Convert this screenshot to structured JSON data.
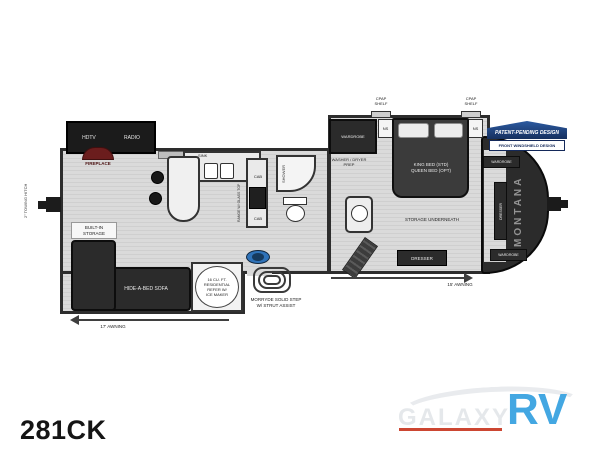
{
  "floorplan": {
    "model": "281CK",
    "brand_vertical": "MONTANA",
    "badge": {
      "title": "PATENT-PENDING DESIGN",
      "subtitle": "FRONT WINDSHIELD DESIGN"
    },
    "exterior": {
      "towing_hitch": "2\" TOWING HITCH",
      "awning_rear": "17' AWNING",
      "awning_front": "15' AWNING",
      "step_line1": "MORRYDE SOLID STEP",
      "step_line2": "W/ STRUT ASSIST"
    },
    "living": {
      "hdtv": "HDTV",
      "radio": "RADIO",
      "fireplace": "FIREPLACE",
      "built_in_storage_line1": "BUILT-IN",
      "built_in_storage_line2": "STORAGE",
      "sofa": "HIDE-A-BED SOFA"
    },
    "kitchen": {
      "sink": "SINK",
      "range": "RANGE W/ GLASS TOP",
      "cab_upper": "CAB",
      "cab_lower": "CAB",
      "refer_line1": "16 CU. FT.",
      "refer_line2": "RESIDENTIAL",
      "refer_line3": "REFER W/",
      "refer_line4": "ICE MAKER"
    },
    "bath": {
      "shower": "SHOWER",
      "washer_dryer_line1": "WASHER / DRYER",
      "washer_dryer_line2": "PREP"
    },
    "bedroom": {
      "wardrobe": "WARDROBE",
      "ns_left": "NS",
      "ns_right": "NS",
      "cpap_left_line1": "CPAP",
      "cpap_left_line2": "SHELF",
      "cpap_right_line1": "CPAP",
      "cpap_right_line2": "SHELF",
      "bed_line1": "KING BED (STD)",
      "bed_line2": "QUEEN BED (OPT)",
      "storage": "STORAGE UNDERNEATH",
      "dresser": "DRESSER"
    },
    "front_closet": {
      "wardrobe_top": "WARDROBE",
      "dresser": "DRESSER",
      "wardrobe_bottom": "WARDROBE"
    }
  },
  "branding": {
    "dealer_name": "GALAXY",
    "dealer_suffix": "RV"
  },
  "colors": {
    "accent_blue": "#43a7e2",
    "underline_red": "#cc4632",
    "badge_navy": "#16305f",
    "step_blue": "#2f72b8",
    "wall_dark": "#2d2d2d"
  }
}
